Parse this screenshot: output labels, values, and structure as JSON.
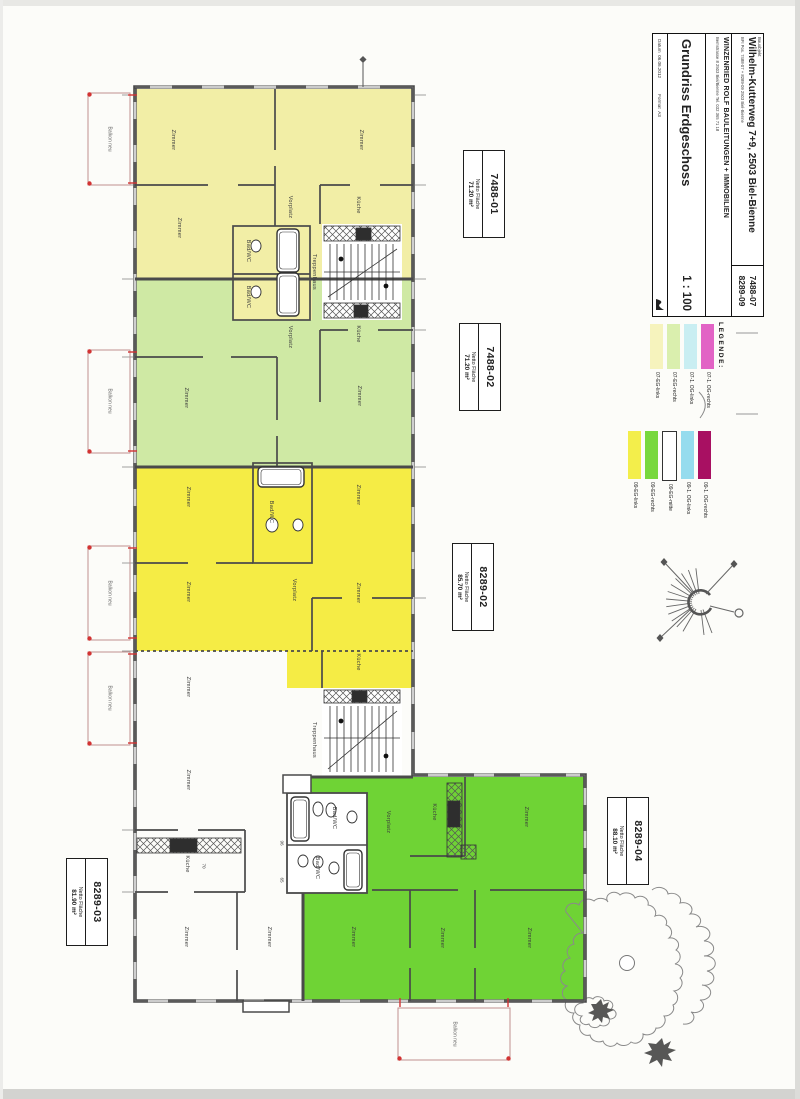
{
  "title_block": {
    "corner_no_1": "7488-07",
    "corner_no_2": "8289-09",
    "object_label": "Bauobjekt",
    "address": "Wilhelm-Kutterweg 7+9, 2503 Biel-Bienne",
    "address_sub": "BFI Pos. 7488-07 + 8289-09   2503 Biel-Bienne",
    "firm": "WINZENRIED ROLF   BAULEITUNGEN + IMMOBILIEN",
    "firm_sub": "Bernstrasse 8    2503 Biel/Bienne    Tel. 032 365 71 18",
    "drawing_title": "Grundriss Erdgeschoss",
    "scale": "1 : 100",
    "date_label": "Datum",
    "date_value": "06.06.2012",
    "format_label": "Format",
    "format_value": "A3"
  },
  "legend": {
    "title": "LEGENDE:",
    "group1": [
      {
        "label": "07-EG-links",
        "color": "#f6f3bd"
      },
      {
        "label": "07-EG-rechts",
        "color": "#daefae"
      },
      {
        "label": "07-1. OG-links",
        "color": "#c9eef2"
      },
      {
        "label": "07-1. OG-rechts",
        "color": "#e263c5"
      }
    ],
    "group2": [
      {
        "label": "09-EG-links",
        "color": "#f3ee4b"
      },
      {
        "label": "09-EG-rechts",
        "color": "#78d83d"
      },
      {
        "label": "09-EG-mitte",
        "color": "#ffffff",
        "outlined": true
      },
      {
        "label": "09-1. OG-links",
        "color": "#96dcee"
      },
      {
        "label": "09-1. OG-rechts",
        "color": "#a81062"
      }
    ]
  },
  "apartments": [
    {
      "id": "7488-01",
      "area_label": "Netto Fläche",
      "area": "71.20 m²"
    },
    {
      "id": "7488-02",
      "area_label": "Netto Fläche",
      "area": "71.20 m²"
    },
    {
      "id": "8289-02",
      "area_label": "Netto Fläche",
      "area": "85.70 m²"
    },
    {
      "id": "8289-04",
      "area_label": "Netto Fläche",
      "area": "88.10 m²"
    },
    {
      "id": "8289-03",
      "area_label": "Netto Fläche",
      "area": "81.90 m²"
    }
  ],
  "plan": {
    "zone_colors": {
      "apt_7488_01": "#f2eea6",
      "apt_7488_02": "#cfe9a4",
      "apt_8289_02": "#f5ec45",
      "apt_8289_03": "#ffffff",
      "apt_8289_04": "#6fd335"
    },
    "balcony_label": "Balkon neu",
    "balcony_label_positions": [
      {
        "x": 109,
        "y": 139
      },
      {
        "x": 109,
        "y": 401
      },
      {
        "x": 109,
        "y": 593
      },
      {
        "x": 109,
        "y": 698
      },
      {
        "x": 454,
        "y": 1034
      }
    ],
    "dim_labels": [
      {
        "text": "70",
        "x": 203,
        "y": 866
      },
      {
        "text": "96",
        "x": 281,
        "y": 843
      },
      {
        "text": "65",
        "x": 281,
        "y": 880
      }
    ],
    "room_labels": [
      {
        "text": "Zimmer",
        "x": 172,
        "y": 140
      },
      {
        "text": "Zimmer",
        "x": 360,
        "y": 140
      },
      {
        "text": "Zimmer",
        "x": 178,
        "y": 228
      },
      {
        "text": "Vorplatz",
        "x": 289,
        "y": 207
      },
      {
        "text": "Küche",
        "x": 357,
        "y": 205
      },
      {
        "text": "Bad/WC",
        "x": 247,
        "y": 251
      },
      {
        "text": "Bad/WC",
        "x": 247,
        "y": 297
      },
      {
        "text": "Treppenhaus",
        "x": 313,
        "y": 272
      },
      {
        "text": "Zimmer",
        "x": 185,
        "y": 398
      },
      {
        "text": "Zimmer",
        "x": 358,
        "y": 396
      },
      {
        "text": "Vorplatz",
        "x": 289,
        "y": 337
      },
      {
        "text": "Küche",
        "x": 357,
        "y": 334
      },
      {
        "text": "Zimmer",
        "x": 187,
        "y": 497
      },
      {
        "text": "Zimmer",
        "x": 357,
        "y": 495
      },
      {
        "text": "Bad/WC",
        "x": 270,
        "y": 512
      },
      {
        "text": "Zimmer",
        "x": 187,
        "y": 592
      },
      {
        "text": "Vorplatz",
        "x": 293,
        "y": 590
      },
      {
        "text": "Zimmer",
        "x": 357,
        "y": 593
      },
      {
        "text": "Küche",
        "x": 357,
        "y": 662
      },
      {
        "text": "Zimmer",
        "x": 187,
        "y": 687
      },
      {
        "text": "Treppenhaus",
        "x": 313,
        "y": 740
      },
      {
        "text": "Zimmer",
        "x": 187,
        "y": 780
      },
      {
        "text": "Küche",
        "x": 186,
        "y": 864
      },
      {
        "text": "Zimmer",
        "x": 185,
        "y": 937
      },
      {
        "text": "Zimmer",
        "x": 268,
        "y": 937
      },
      {
        "text": "Bad/WC",
        "x": 333,
        "y": 818
      },
      {
        "text": "Bad/WC",
        "x": 316,
        "y": 868
      },
      {
        "text": "Vorplatz",
        "x": 387,
        "y": 822
      },
      {
        "text": "Küche",
        "x": 433,
        "y": 812
      },
      {
        "text": "Zimmer",
        "x": 525,
        "y": 817
      },
      {
        "text": "Zimmer",
        "x": 352,
        "y": 937
      },
      {
        "text": "Zimmer",
        "x": 441,
        "y": 938
      },
      {
        "text": "Zimmer",
        "x": 528,
        "y": 938
      }
    ]
  }
}
